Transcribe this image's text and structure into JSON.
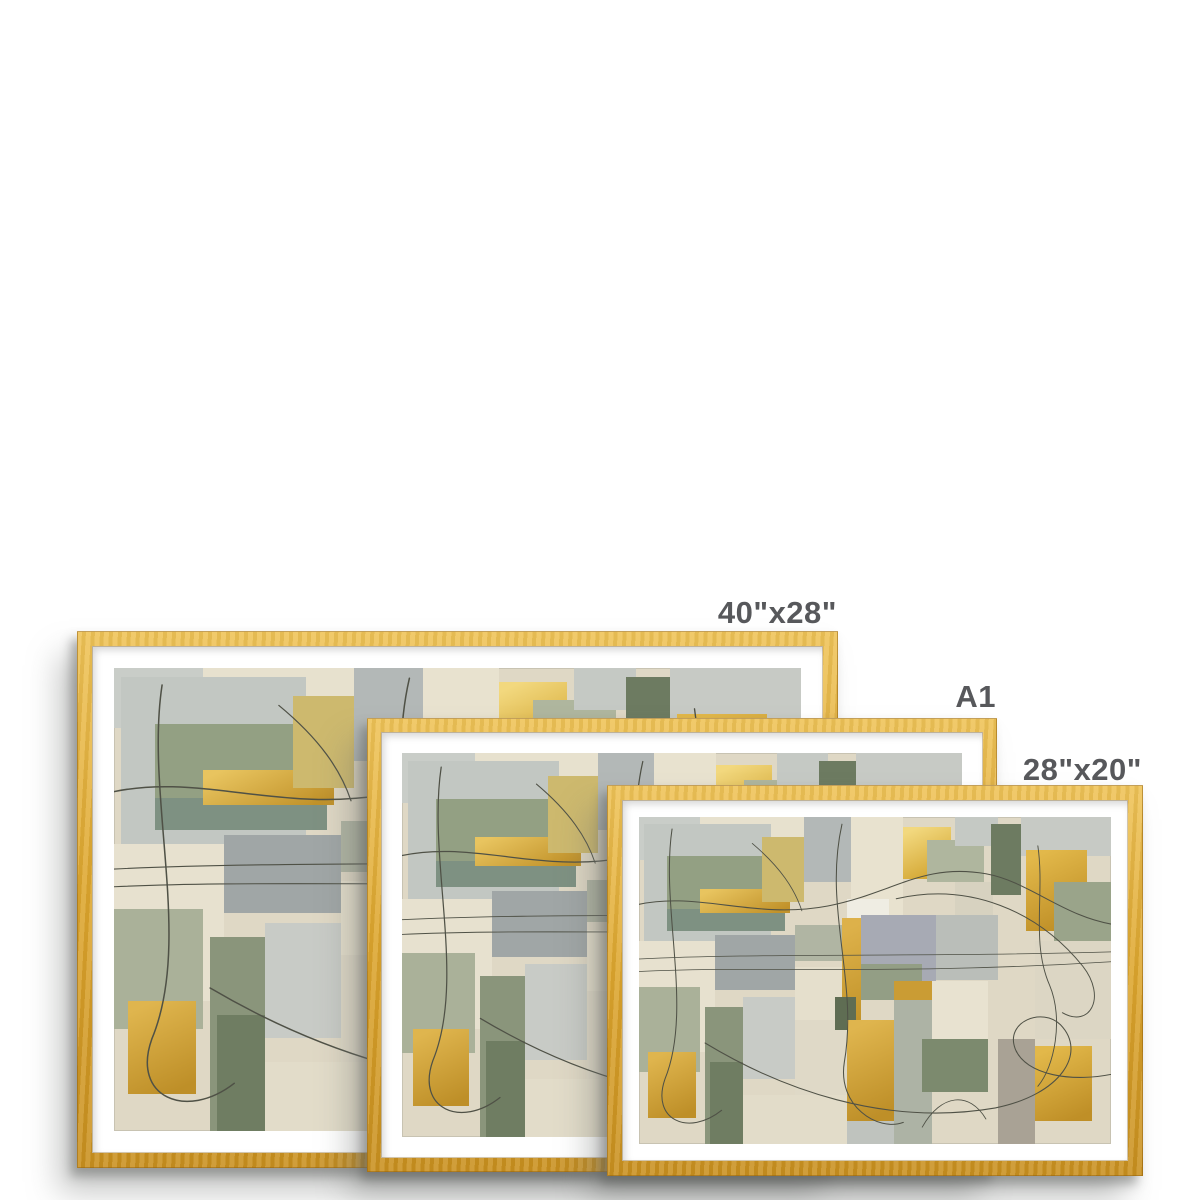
{
  "page": {
    "background": "#ffffff",
    "description": "Framed print size comparison"
  },
  "colors": {
    "frame_gold": "#DDA62E",
    "frame_gold_light": "#EFC357",
    "frame_gold_dark": "#C9901F",
    "mat_white": "#ffffff",
    "label_text": "#57585B",
    "shadow_gray": "#8A8C8A"
  },
  "frames": [
    {
      "label": "40\"x28\"",
      "left": 77,
      "top": 631,
      "width": 761,
      "height": 537,
      "border": 15,
      "mat": 22,
      "z": 1,
      "label_dy": -34
    },
    {
      "label": "A1",
      "left": 367,
      "top": 718,
      "width": 630,
      "height": 454,
      "border": 14,
      "mat": 21,
      "z": 2,
      "label_dy": -37
    },
    {
      "label": "28\"x20\"",
      "left": 607,
      "top": 785,
      "width": 536,
      "height": 391,
      "border": 15,
      "mat": 17,
      "z": 3,
      "label_dy": -31
    }
  ],
  "artwork": {
    "name": "abstract-collage-sage-gold",
    "background": "#DFD8C5",
    "line_color": "#4F5146",
    "patches": [
      {
        "x": 0,
        "y": 0,
        "w": 13,
        "h": 13,
        "c": "#C9CDC8"
      },
      {
        "x": 13,
        "y": 0,
        "w": 22,
        "h": 9,
        "c": "#E7E1CE"
      },
      {
        "x": 1,
        "y": 2,
        "w": 27,
        "h": 36,
        "c": "#C2C7C2"
      },
      {
        "x": 6,
        "y": 12,
        "w": 25,
        "h": 23,
        "c": "#93A083"
      },
      {
        "x": 6,
        "y": 28,
        "w": 25,
        "h": 7,
        "c": "#7E9182"
      },
      {
        "x": 13,
        "y": 22,
        "w": 19,
        "h": 7.5,
        "g": [
          "#E8C45F",
          "#C1922A"
        ]
      },
      {
        "x": 26,
        "y": 6,
        "w": 9,
        "h": 20,
        "c": "#CDB96E"
      },
      {
        "x": 35,
        "y": 0,
        "w": 10,
        "h": 20,
        "c": "#B3B8B7"
      },
      {
        "x": 45,
        "y": 0,
        "w": 11,
        "h": 30,
        "c": "#E8E2CF"
      },
      {
        "x": 44,
        "y": 25,
        "w": 9,
        "h": 9,
        "c": "#EFEDE3"
      },
      {
        "x": 56,
        "y": 3,
        "w": 10,
        "h": 16,
        "g": [
          "#F2D87E",
          "#D2A42F"
        ]
      },
      {
        "x": 61,
        "y": 7,
        "w": 12,
        "h": 13,
        "c": "#AFB69E"
      },
      {
        "x": 67,
        "y": 0,
        "w": 9,
        "h": 9,
        "c": "#C5C9C4"
      },
      {
        "x": 67,
        "y": 20,
        "w": 8,
        "h": 12,
        "c": "#D7D2C0"
      },
      {
        "x": 74.5,
        "y": 2,
        "w": 6.5,
        "h": 22,
        "c": "#6D7B61"
      },
      {
        "x": 81,
        "y": 0,
        "w": 19,
        "h": 12,
        "c": "#C7CAC5"
      },
      {
        "x": 82,
        "y": 10,
        "w": 13,
        "h": 25,
        "g": [
          "#E2B84A",
          "#BE8E26"
        ]
      },
      {
        "x": 88,
        "y": 20,
        "w": 12,
        "h": 18,
        "c": "#9AA48A"
      },
      {
        "x": 84,
        "y": 38,
        "w": 16,
        "h": 30,
        "c": "#DCD6C4"
      },
      {
        "x": 63,
        "y": 30,
        "w": 13,
        "h": 20,
        "c": "#BABEB9"
      },
      {
        "x": 47,
        "y": 30,
        "w": 16,
        "h": 21,
        "c": "#A7AAB4"
      },
      {
        "x": 16,
        "y": 36,
        "w": 17,
        "h": 17,
        "c": "#A0A6A6"
      },
      {
        "x": 33,
        "y": 33,
        "w": 14,
        "h": 11,
        "c": "#B0B5A3"
      },
      {
        "x": 43,
        "y": 31,
        "w": 4,
        "h": 41,
        "g": [
          "#DDB14A",
          "#BD8E24"
        ]
      },
      {
        "x": 47,
        "y": 45,
        "w": 13,
        "h": 11,
        "c": "#939E85"
      },
      {
        "x": 54,
        "y": 50,
        "w": 8,
        "h": 14,
        "c": "#CA9C34"
      },
      {
        "x": 33,
        "y": 46,
        "w": 10,
        "h": 16,
        "c": "#E5DFCC"
      },
      {
        "x": 0,
        "y": 38,
        "w": 16,
        "h": 34,
        "c": "#E7E1CF"
      },
      {
        "x": 0,
        "y": 52,
        "w": 13,
        "h": 26,
        "c": "#AAB199"
      },
      {
        "x": 2,
        "y": 72,
        "w": 10,
        "h": 20,
        "g": [
          "#DFB54E",
          "#BE8F28"
        ]
      },
      {
        "x": 14,
        "y": 58,
        "w": 8,
        "h": 42,
        "c": "#8A957B"
      },
      {
        "x": 15,
        "y": 75,
        "w": 7,
        "h": 25,
        "c": "#6F7D62"
      },
      {
        "x": 22,
        "y": 55,
        "w": 11,
        "h": 25,
        "c": "#C8CBC6"
      },
      {
        "x": 33,
        "y": 62,
        "w": 11,
        "h": 23,
        "c": "#DFD9C7"
      },
      {
        "x": 41.5,
        "y": 55,
        "w": 4.5,
        "h": 10,
        "c": "#5F6D53"
      },
      {
        "x": 44,
        "y": 62,
        "w": 10,
        "h": 31,
        "g": [
          "#DFB54E",
          "#BE8F28"
        ]
      },
      {
        "x": 54,
        "y": 56,
        "w": 8,
        "h": 44,
        "c": "#ADB3A5"
      },
      {
        "x": 62,
        "y": 50,
        "w": 12,
        "h": 25,
        "c": "#E8E2D0"
      },
      {
        "x": 60,
        "y": 68,
        "w": 14,
        "h": 16,
        "c": "#7C8A6E"
      },
      {
        "x": 76,
        "y": 68,
        "w": 8,
        "h": 32,
        "c": "#A9A295"
      },
      {
        "x": 84,
        "y": 70,
        "w": 12,
        "h": 23,
        "g": [
          "#E2B84A",
          "#BF8F27"
        ]
      },
      {
        "x": 22,
        "y": 85,
        "w": 22,
        "h": 15,
        "c": "#E2DCC9"
      },
      {
        "x": 44,
        "y": 93,
        "w": 10,
        "h": 7,
        "c": "#BFC3BE"
      }
    ],
    "lines": [
      {
        "d": "M -15 185 C 120 150, 240 215, 400 185 C 540 158, 600 95, 735 118 C 830 135, 900 210, 1015 225",
        "w": 2.2
      },
      {
        "d": "M -15 296 C 250 282, 620 292, 1015 280",
        "w": 1.6
      },
      {
        "d": "M -15 322 C 260 308, 540 330, 1015 300",
        "w": 1.6
      },
      {
        "d": "M 70 25 C 45 190, 115 400, 55 545 C 25 630, 105 665, 175 610",
        "w": 2.2
      },
      {
        "d": "M 430 15 C 390 190, 465 340, 435 510 C 420 600, 505 655, 560 635",
        "w": 2.2
      },
      {
        "d": "M 140 470 C 300 565, 520 645, 755 605 C 895 577, 950 490, 893 432 C 855 395, 775 425, 797 482 C 818 536, 918 555, 1015 532",
        "w": 2.2
      },
      {
        "d": "M 545 170 C 700 135, 845 195, 940 310 C 992 375, 955 440, 897 407",
        "w": 2
      },
      {
        "d": "M 240 55 C 300 105, 330 150, 345 195",
        "w": 1.8
      },
      {
        "d": "M 845 60 C 860 160, 830 260, 870 350 C 900 420, 880 520, 845 560",
        "w": 2
      },
      {
        "d": "M 600 645 C 640 575, 700 570, 735 628",
        "w": 1.8
      }
    ]
  }
}
